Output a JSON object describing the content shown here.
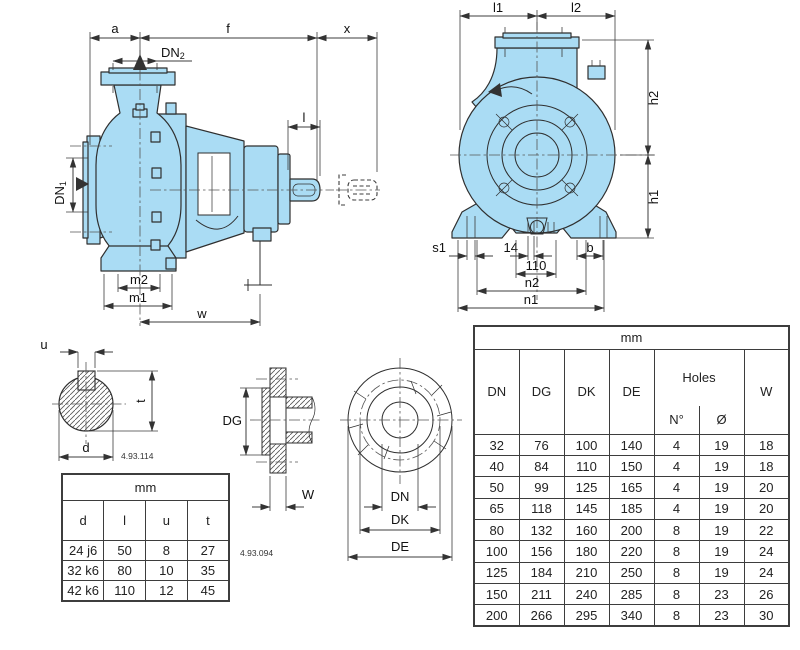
{
  "colors": {
    "pump_fill": "#AADCF4",
    "line": "#2f2f2f",
    "dim_line": "#3d3d3d",
    "table_border": "#3d3d3d",
    "background": "#ffffff"
  },
  "side_view": {
    "dims": {
      "a": "a",
      "f": "f",
      "x": "x",
      "l": "l",
      "m2": "m2",
      "m1": "m1",
      "w": "w"
    },
    "dn1": {
      "base": "DN",
      "sub": "1"
    },
    "dn2": {
      "base": "DN",
      "sub": "2"
    }
  },
  "front_view": {
    "dims": {
      "l1": "l1",
      "l2": "l2",
      "h2": "h2",
      "h1": "h1",
      "s1": "s1",
      "d14": "14",
      "d110": "110",
      "b": "b",
      "n2": "n2",
      "n1": "n1"
    }
  },
  "shaft_section": {
    "dims": {
      "u": "u",
      "t": "t",
      "d": "d"
    },
    "ref": "4.93.114"
  },
  "shaft_table": {
    "unit": "mm",
    "columns": [
      "d",
      "l",
      "u",
      "t"
    ],
    "rows": [
      [
        "24 j6",
        "50",
        "8",
        "27"
      ],
      [
        "32 k6",
        "80",
        "10",
        "35"
      ],
      [
        "42 k6",
        "110",
        "12",
        "45"
      ]
    ]
  },
  "flange_section": {
    "dims": {
      "dg": "DG",
      "w": "W"
    },
    "ref": "4.93.094"
  },
  "flange_front": {
    "dims": {
      "dn": "DN",
      "dk": "DK",
      "de": "DE"
    }
  },
  "flange_table": {
    "unit": "mm",
    "headers": {
      "dn": "DN",
      "dg": "DG",
      "dk": "DK",
      "de": "DE",
      "holes": "Holes",
      "n": "N°",
      "dia": "Ø",
      "w": "W"
    },
    "rows": [
      [
        "32",
        "76",
        "100",
        "140",
        "4",
        "19",
        "18"
      ],
      [
        "40",
        "84",
        "110",
        "150",
        "4",
        "19",
        "18"
      ],
      [
        "50",
        "99",
        "125",
        "165",
        "4",
        "19",
        "20"
      ],
      [
        "65",
        "118",
        "145",
        "185",
        "4",
        "19",
        "20"
      ],
      [
        "80",
        "132",
        "160",
        "200",
        "8",
        "19",
        "22"
      ],
      [
        "100",
        "156",
        "180",
        "220",
        "8",
        "19",
        "24"
      ],
      [
        "125",
        "184",
        "210",
        "250",
        "8",
        "19",
        "24"
      ],
      [
        "150",
        "211",
        "240",
        "285",
        "8",
        "23",
        "26"
      ],
      [
        "200",
        "266",
        "295",
        "340",
        "8",
        "23",
        "30"
      ]
    ]
  }
}
